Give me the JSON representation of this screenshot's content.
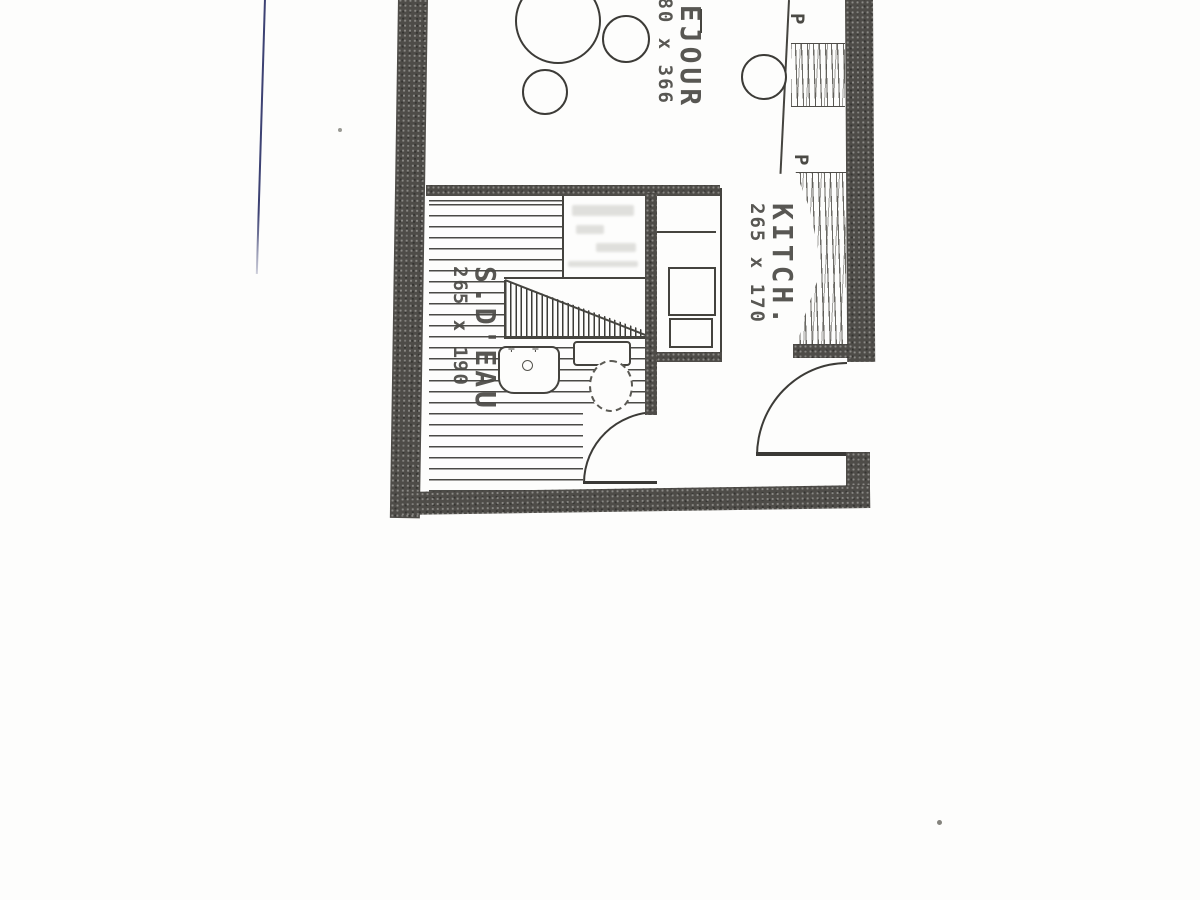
{
  "meta": {
    "description": "Scanned floor plan of a small studio apartment (partial view, top of plan cut off)",
    "language": "French"
  },
  "colors": {
    "paper": "#fdfdfc",
    "ink": "#45443f",
    "wall_gray": "#4e4c48",
    "pen_mark_blue": "#3d4273"
  },
  "rooms": [
    {
      "id": "sejour",
      "label": "SEJOUR",
      "dimensions": "180 x 366"
    },
    {
      "id": "kitchen",
      "label": "KITCH.",
      "dimensions": "265 x 170"
    },
    {
      "id": "shower-room",
      "label": "S.D'EAU",
      "dimensions": "265 x 190"
    }
  ],
  "closets": {
    "labels": [
      "P",
      "P"
    ]
  },
  "icons": {
    "faucet_glyph": "✛"
  }
}
